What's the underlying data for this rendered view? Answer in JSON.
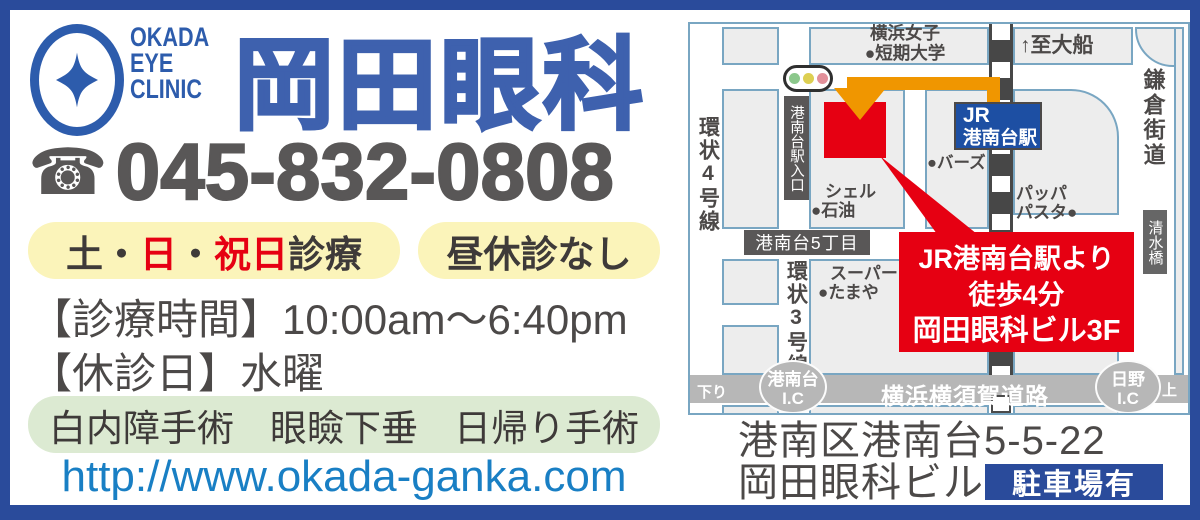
{
  "brand": {
    "logo_lines": [
      "OKADA",
      "EYE",
      "CLINIC"
    ],
    "title": "岡田眼科"
  },
  "phone": {
    "icon": "telephone-icon",
    "number": "045-832-0808"
  },
  "badges": {
    "sat_sun_holiday": {
      "segments": [
        {
          "text": "土",
          "color": "dark"
        },
        {
          "text": "・",
          "color": "dark"
        },
        {
          "text": "日",
          "color": "red"
        },
        {
          "text": "・",
          "color": "dark"
        },
        {
          "text": "祝日",
          "color": "red"
        },
        {
          "text": "診療",
          "color": "dark"
        }
      ]
    },
    "no_lunch_break": "昼休診なし"
  },
  "hours": {
    "label": "【診療時間】",
    "value": "10:00am〜6:40pm"
  },
  "closed": {
    "label": "【休診日】",
    "value": "水曜"
  },
  "services": {
    "items": [
      "白内障手術",
      "眼瞼下垂",
      "日帰り手術"
    ]
  },
  "website": "http://www.okada-ganka.com",
  "map": {
    "university": {
      "line1": "横浜女子",
      "line2": "●短期大学"
    },
    "to_ofuna": "↑至大船",
    "kamakura_kaido": "鎌倉街道",
    "ring4": "環状4号線",
    "station_entrance_sign": "港南台駅入口",
    "station": {
      "line1": "JR",
      "line2": "港南台駅"
    },
    "birds": "●バーズ",
    "shell": {
      "line1": "シェル",
      "line2": "●石油"
    },
    "pappa": {
      "line1": "パッパ",
      "line2": "パスタ●"
    },
    "shimizubashi": "清水橋",
    "konandai5": "港南台5丁目",
    "ring3": "環状3号線",
    "tamaya": {
      "line1": "スーパー",
      "line2": "●たまや"
    },
    "callout": {
      "line1": "JR港南台駅より",
      "line2": "徒歩4分",
      "line3": "岡田眼科ビル3F"
    },
    "highway": {
      "name": "横浜横須賀道路",
      "ic_left": {
        "line1": "港南台",
        "line2": "I.C"
      },
      "ic_right": {
        "line1": "日野",
        "line2": "I.C"
      },
      "down": "下り",
      "up": "上り"
    }
  },
  "address": {
    "line1": "港南区港南台5-5-22",
    "line2": "岡田眼科ビル3F",
    "parking": "駐車場有"
  },
  "colors": {
    "brand_blue": "#2a4b9b",
    "title_blue": "#3e61ae",
    "accent_red": "#e60012",
    "url_blue": "#197fc4",
    "highlight_yellow": "#fbf4ba",
    "highlight_green": "#dcead2",
    "station_blue": "#1d4fa3",
    "route_orange": "#f09600"
  }
}
